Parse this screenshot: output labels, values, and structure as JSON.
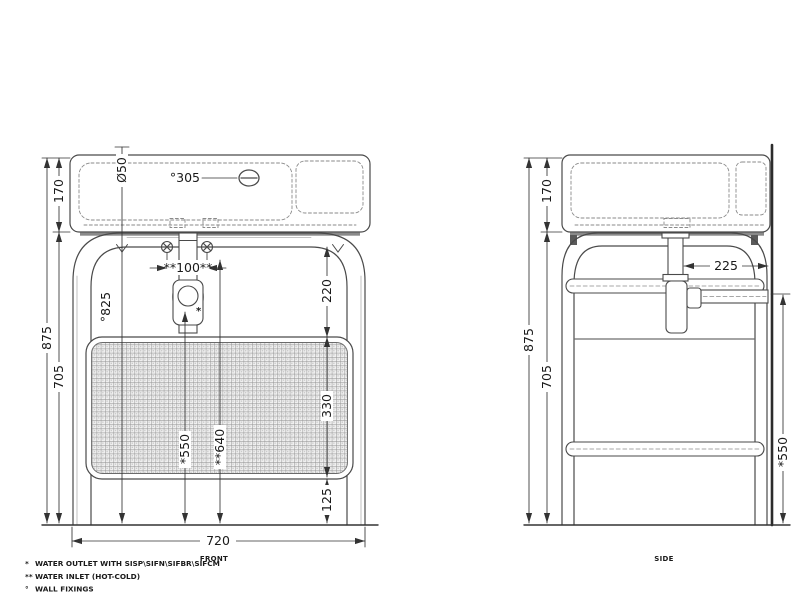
{
  "drawing_title": "washbasin console technical drawing",
  "front_view": {
    "caption": "FRONT",
    "dimensions": {
      "basin_height": "170",
      "total_height": "875",
      "frame_height": "705",
      "overall_width": "720",
      "hole_diameter": "Ø50",
      "fixing_offset": "°305",
      "fixing_height": "°825",
      "inlet_spacing": "**100**",
      "rail_to_panel": "220",
      "panel_height": "330",
      "panel_to_floor": "125",
      "outlet_height": "*550",
      "inlet_height": "**640"
    },
    "marks": {
      "outlet": "*"
    }
  },
  "side_view": {
    "caption": "SIDE",
    "dimensions": {
      "basin_height": "170",
      "total_height": "875",
      "frame_height": "705",
      "trap_to_wall": "225",
      "fixing_height": "*550"
    }
  },
  "footnotes": [
    {
      "marker": "*",
      "text": "WATER OUTLET WITH SISP\\SIFN\\SIFBR\\SIFCM"
    },
    {
      "marker": "**",
      "text": "WATER INLET (HOT-COLD)"
    },
    {
      "marker": "°",
      "text": "WALL FIXINGS"
    }
  ],
  "colors": {
    "line": "#4a4a4a",
    "dim_line": "#333333",
    "dashed": "#8a8a8a",
    "mesh": "#9a9a9a"
  }
}
